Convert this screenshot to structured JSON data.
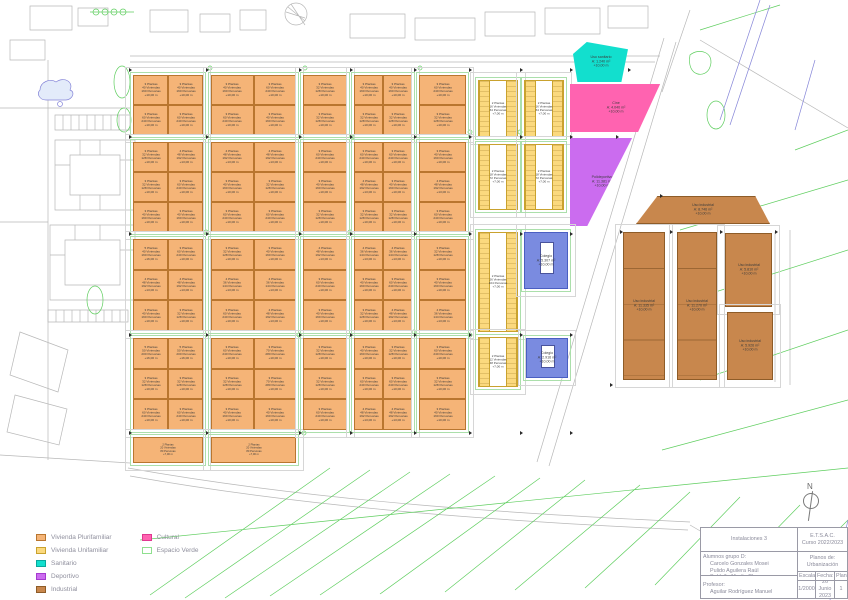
{
  "title": "Plano de Urbanización",
  "legend": {
    "items": [
      {
        "label": "Vivienda Plurifamiliar",
        "color": "#f5b477",
        "outline": "#b9762f"
      },
      {
        "label": "Vivienda Unifamiliar",
        "color": "#fbd97e",
        "outline": "#c9a22e"
      },
      {
        "label": "Sanitario",
        "color": "#12dfce",
        "outline": "#0aa89c"
      },
      {
        "label": "Deportivo",
        "color": "#cb6cef",
        "outline": "#a53acf"
      },
      {
        "label": "Industrial",
        "color": "#c8874d",
        "outline": "#8e5c28"
      },
      {
        "label": "Cultural",
        "color": "#ff63b0",
        "outline": "#e03890"
      },
      {
        "label": "Espacio Verde",
        "color": "#ffffff",
        "outline": "#8fe08f"
      }
    ]
  },
  "titleblock": {
    "project": "Instalaciones 3",
    "school": "E.T.S.A.C.",
    "course": "Curso 2022/2023",
    "students_label": "Alumnos grupo D:",
    "students": [
      "Carcelo Gonzales Mosei",
      "Pulido Aguilera Raúl",
      "Saldaña Martín Clara"
    ],
    "plans_label": "Planos de:",
    "plans_value": "Urbanización",
    "professor_label": "Profesor:",
    "professor": "Aguilar Rodríguez Manuel",
    "scale_label": "Escala:",
    "scale": "1/2000",
    "date_label": "Fecha:",
    "date": "26 Junio 2023",
    "sheet_label": "Plano:",
    "sheet": "1"
  },
  "map": {
    "north_label": "N",
    "presets": {
      "1": [
        "3 Plantas",
        "40 Viviendas",
        "160 Personas",
        "+10,00 m"
      ],
      "2": [
        "3 Plantas",
        "60 Viviendas",
        "240 Personas",
        "+10,00 m"
      ],
      "3": [
        "4 Plantas",
        "48 Viviendas",
        "192 Personas",
        "+13,00 m"
      ],
      "4": [
        "5 Plantas",
        "40 Viviendas",
        "160 Personas",
        "+16,00 m"
      ],
      "5": [
        "5 Plantas",
        "50 Viviendas",
        "200 Personas",
        "+16,00 m"
      ],
      "6": [
        "3 Plantas",
        "32 Viviendas",
        "128 Personas",
        "+10,00 m"
      ],
      "7": [
        "4 Plantas",
        "36 Viviendas",
        "144 Personas",
        "+13,00 m"
      ],
      "8": [
        "3 Plantas",
        "70 Viviendas",
        "280 Personas",
        "+10,00 m"
      ],
      "9": [
        "2 Plantas",
        "20 Viviendas",
        "80 Personas",
        "+7,00 m"
      ]
    },
    "blocks": [
      {
        "x": 133,
        "y": 75,
        "w": 70,
        "h": 60,
        "cols": 2,
        "rows": 2,
        "p": [
          "1",
          "1",
          "2",
          "2"
        ]
      },
      {
        "x": 133,
        "y": 142,
        "w": 70,
        "h": 90,
        "cols": 2,
        "rows": 3,
        "p": [
          "6",
          "3",
          "6",
          "2",
          "1",
          "1"
        ]
      },
      {
        "x": 133,
        "y": 239,
        "w": 70,
        "h": 92,
        "cols": 2,
        "rows": 3,
        "p": [
          "4",
          "2",
          "3",
          "3",
          "1",
          "6"
        ]
      },
      {
        "x": 133,
        "y": 338,
        "w": 70,
        "h": 92,
        "cols": 2,
        "rows": 3,
        "p": [
          "5",
          "5",
          "6",
          "6",
          "2",
          "2"
        ]
      },
      {
        "x": 133,
        "y": 437,
        "w": 70,
        "h": 26,
        "cols": 1,
        "rows": 1,
        "p": [
          "9"
        ]
      },
      {
        "x": 211,
        "y": 75,
        "w": 85,
        "h": 60,
        "cols": 2,
        "rows": 2,
        "p": [
          "1",
          "2",
          "2",
          "1"
        ]
      },
      {
        "x": 211,
        "y": 142,
        "w": 85,
        "h": 90,
        "cols": 2,
        "rows": 3,
        "p": [
          "3",
          "3",
          "1",
          "6",
          "2",
          "2"
        ]
      },
      {
        "x": 211,
        "y": 239,
        "w": 85,
        "h": 92,
        "cols": 2,
        "rows": 3,
        "p": [
          "6",
          "1",
          "7",
          "7",
          "2",
          "3"
        ]
      },
      {
        "x": 211,
        "y": 338,
        "w": 85,
        "h": 92,
        "cols": 2,
        "rows": 3,
        "p": [
          "2",
          "8",
          "6",
          "8",
          "1",
          "1"
        ]
      },
      {
        "x": 211,
        "y": 437,
        "w": 85,
        "h": 26,
        "cols": 1,
        "rows": 1,
        "p": [
          "9"
        ]
      },
      {
        "x": 303,
        "y": 75,
        "w": 44,
        "h": 60,
        "cols": 1,
        "rows": 2,
        "p": [
          "6",
          "6"
        ]
      },
      {
        "x": 303,
        "y": 142,
        "w": 44,
        "h": 90,
        "cols": 1,
        "rows": 3,
        "p": [
          "2",
          "1",
          "6"
        ]
      },
      {
        "x": 303,
        "y": 239,
        "w": 44,
        "h": 92,
        "cols": 1,
        "rows": 3,
        "p": [
          "3",
          "2",
          "1"
        ]
      },
      {
        "x": 303,
        "y": 338,
        "w": 44,
        "h": 92,
        "cols": 1,
        "rows": 3,
        "p": [
          "6",
          "6",
          "2"
        ]
      },
      {
        "x": 354,
        "y": 75,
        "w": 58,
        "h": 60,
        "cols": 2,
        "rows": 2,
        "p": [
          "1",
          "1",
          "6",
          "6"
        ]
      },
      {
        "x": 354,
        "y": 142,
        "w": 58,
        "h": 90,
        "cols": 2,
        "rows": 3,
        "p": [
          "2",
          "2",
          "3",
          "1",
          "6",
          "6"
        ]
      },
      {
        "x": 354,
        "y": 239,
        "w": 58,
        "h": 92,
        "cols": 2,
        "rows": 3,
        "p": [
          "7",
          "7",
          "1",
          "2",
          "6",
          "3"
        ]
      },
      {
        "x": 354,
        "y": 338,
        "w": 58,
        "h": 92,
        "cols": 2,
        "rows": 3,
        "p": [
          "1",
          "6",
          "2",
          "2",
          "3",
          "3"
        ]
      },
      {
        "x": 419,
        "y": 75,
        "w": 47,
        "h": 60,
        "cols": 1,
        "rows": 2,
        "p": [
          "2",
          "6"
        ]
      },
      {
        "x": 419,
        "y": 142,
        "w": 47,
        "h": 90,
        "cols": 1,
        "rows": 3,
        "p": [
          "1",
          "3",
          "2"
        ]
      },
      {
        "x": 419,
        "y": 239,
        "w": 47,
        "h": 92,
        "cols": 1,
        "rows": 3,
        "p": [
          "6",
          "1",
          "7"
        ]
      },
      {
        "x": 419,
        "y": 338,
        "w": 47,
        "h": 92,
        "cols": 1,
        "rows": 3,
        "p": [
          "2",
          "6",
          "1"
        ]
      }
    ],
    "uni_blocks": [
      {
        "x": 478,
        "y": 80,
        "w": 40,
        "h": 57,
        "label": [
          "2 Plantas",
          "16 Viviendas",
          "64 Personas",
          "+7,00 m"
        ]
      },
      {
        "x": 524,
        "y": 80,
        "w": 40,
        "h": 57,
        "label": [
          "2 Plantas",
          "16 Viviendas",
          "64 Personas",
          "+7,00 m"
        ]
      },
      {
        "x": 478,
        "y": 144,
        "w": 40,
        "h": 66,
        "label": [
          "2 Plantas",
          "18 Viviendas",
          "72 Personas",
          "+7,00 m"
        ]
      },
      {
        "x": 524,
        "y": 144,
        "w": 40,
        "h": 66,
        "label": [
          "2 Plantas",
          "18 Viviendas",
          "72 Personas",
          "+7,00 m"
        ]
      },
      {
        "x": 478,
        "y": 232,
        "w": 40,
        "h": 100,
        "label": [
          "2 Plantas",
          "26 Viviendas",
          "104 Personas",
          "+7,00 m"
        ]
      },
      {
        "x": 478,
        "y": 337,
        "w": 40,
        "h": 50,
        "label": [
          "2 Plantas",
          "12 Viviendas",
          "48 Personas",
          "+7,00 m"
        ]
      }
    ],
    "special": [
      {
        "type": "sanitario",
        "x": 573,
        "y": 42,
        "w": 55,
        "h": 40,
        "clip": "polygon(25% 0%, 100% 18%, 88% 100%, 8% 100%, 0% 30%)",
        "label": [
          "Uso sanitario",
          "A: 1.240 m²",
          "+10,00 m"
        ]
      },
      {
        "type": "cultural",
        "x": 570,
        "y": 84,
        "w": 92,
        "h": 48,
        "clip": "polygon(0 0, 98% 0, 74% 100%, 0 100%)",
        "label": [
          "Cine",
          "A: 4.040 m²",
          "+10,00 m"
        ]
      },
      {
        "type": "deportivo",
        "x": 570,
        "y": 138,
        "w": 64,
        "h": 88,
        "clip": "polygon(0 0, 97% 0, 27% 100%, 0 100%)",
        "label": [
          "Polideportivo",
          "A: 11.381 m²",
          "+10,00 m"
        ]
      },
      {
        "type": "industrial",
        "x": 636,
        "y": 196,
        "w": 134,
        "h": 28,
        "clip": "polygon(16% 0, 89% 0, 100% 100%, 0 100%)",
        "label": [
          "Uso industrial",
          "A: 8.746 m²",
          "+10,00 m"
        ]
      },
      {
        "type": "industrial tall",
        "x": 623,
        "y": 232,
        "w": 42,
        "h": 148,
        "label": [
          "Uso industrial",
          "A: 11.335 m²",
          "+10,00 m"
        ]
      },
      {
        "type": "industrial tall",
        "x": 677,
        "y": 232,
        "w": 40,
        "h": 148,
        "label": [
          "Uso industrial",
          "A: 11.270 m²",
          "+10,00 m"
        ]
      },
      {
        "type": "industrial",
        "x": 725,
        "y": 233,
        "w": 47,
        "h": 74,
        "label": [
          "Uso industrial",
          "A: 5.810 m²",
          "+10,00 m"
        ]
      },
      {
        "type": "industrial",
        "x": 727,
        "y": 312,
        "w": 46,
        "h": 68,
        "label": [
          "Uso industrial",
          "A: 5.926 m²",
          "+10,00 m"
        ]
      },
      {
        "type": "docente",
        "x": 524,
        "y": 232,
        "w": 44,
        "h": 57,
        "label": [
          "Colegio",
          "A: 5.307 m²",
          "+10,00 m"
        ]
      },
      {
        "type": "docente",
        "x": 526,
        "y": 338,
        "w": 42,
        "h": 40,
        "label": [
          "Colegio",
          "A: 2.916 m²",
          "+10,00 m"
        ]
      }
    ]
  }
}
